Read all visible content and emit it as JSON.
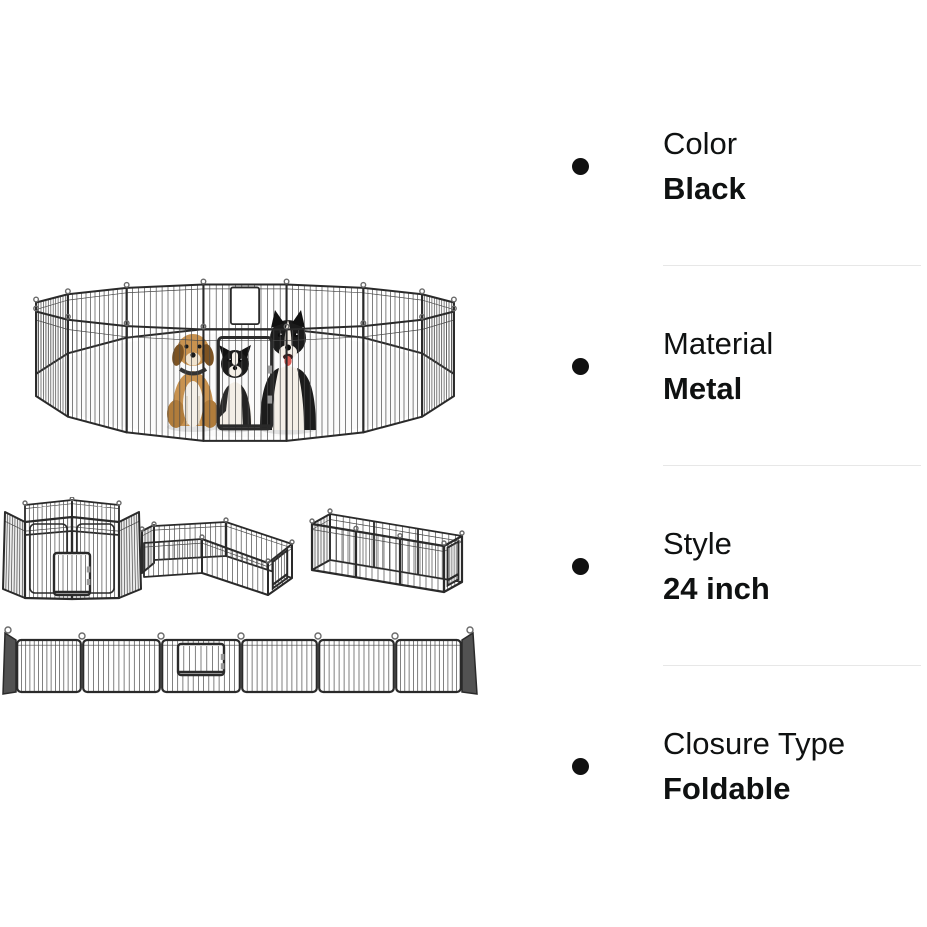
{
  "attributes": [
    {
      "label": "Color",
      "value": "Black"
    },
    {
      "label": "Material",
      "value": "Metal"
    },
    {
      "label": "Style",
      "value": "24 inch"
    },
    {
      "label": "Closure Type",
      "value": "Foldable"
    }
  ],
  "icons": {
    "bullet": "filled-circle"
  },
  "style": {
    "background": "#ffffff",
    "text_color": "#0F1111",
    "bullet_color": "#111111",
    "divider_color": "#e7e7e7"
  },
  "figure_colors": {
    "frame": "#2a2a2a",
    "wire": "#4a4a4a",
    "hook": "#6a6a6a",
    "end_cap": "#525252",
    "floor": "#fbfbfb",
    "shadow": "#e3e3e3",
    "dog_tan": "#c8924f",
    "dog_tan_dark": "#b07c3b",
    "dog_ear_brown": "#7d5322",
    "dog_black": "#1b1b1b",
    "dog_white": "#f4efe7",
    "tongue": "#d95a52"
  },
  "images": {
    "main": {
      "alt": "16-panel black metal playpen arranged in a circle with three dogs inside and a front door"
    },
    "hexagon": {
      "alt": "playpen panels arranged as a small hexagon pen with door"
    },
    "lshape": {
      "alt": "playpen panels arranged in an L-shaped pen with door"
    },
    "rectangle": {
      "alt": "playpen panels arranged as a long rectangular pen with door at the end"
    },
    "flat": {
      "alt": "playpen panels unfolded flat into a straight row with a door panel"
    }
  }
}
